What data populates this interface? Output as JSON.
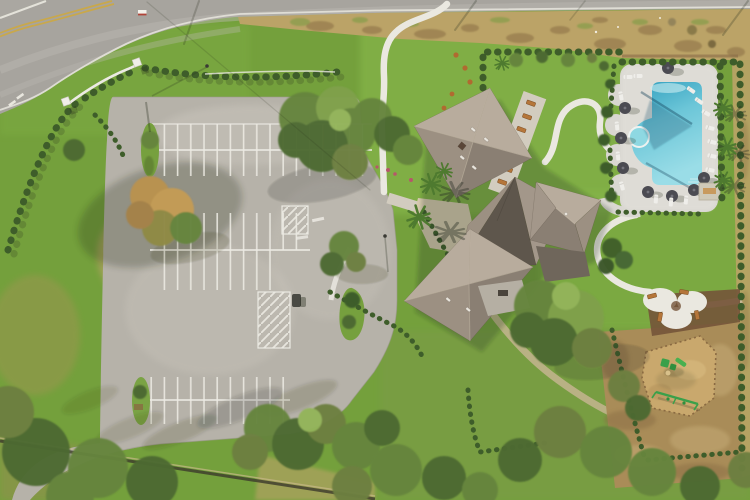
{
  "scene": {
    "type": "aerial-drone-photograph",
    "alt": "Aerial top-down drone view of a community clubhouse amenity center with a large empty parking lot, hip-roofed clubhouse, free-form swimming pool with white paver deck, playground with mulch, curving white sidewalks, hedges, palms and oak trees beside a curving two-lane road",
    "time_of_day": "daytime"
  },
  "road": {
    "lanes": 2,
    "center_line": "double-yellow",
    "edge_line": "white",
    "shape": "runs along top edge, curving down to exit left edge",
    "shoulder": "dry tan grass strip with dirt patches"
  },
  "parking_lot": {
    "surface": "light gray asphalt",
    "stall_rows": 3,
    "stall_line_color": "white",
    "handicap_hatch_zones": 2,
    "landscape_islands": 2,
    "vehicles": 1,
    "state": "empty"
  },
  "clubhouse": {
    "roof_style": "multiple hip roofs meeting in a star",
    "roof_color": "taupe-gray shingle",
    "wings": 4,
    "patio_benches": 7,
    "roof_vents": 6
  },
  "pool_area": {
    "water_color": "turquoise",
    "deck": "white pavers",
    "shape": "rectangle with scalloped west lobes and round spa",
    "loungers": 16,
    "umbrellas": 8,
    "hedge_border": true,
    "palms_east": 3
  },
  "playground": {
    "surface": "tan engineered mulch",
    "equipment": [
      "play-structure",
      "slide",
      "swing-set"
    ],
    "pad": "white concrete with 4 benches",
    "surrounding": "bare dirt field with hedge rows"
  },
  "landscape": {
    "entrance_monument": "white curved wall with two square posts",
    "hedge_style": "rows of round boxwood shrubs",
    "palms_total": 7,
    "autumn_tree": 1,
    "oak_clusters": 6,
    "perimeter_fence_bottom": true
  },
  "palette": {
    "grass_base": "#74a03c",
    "grass_bright": "#8abb4e",
    "grass_verge": "#7dab43",
    "grass_olive": "#7d9a4b",
    "dry_grass": "#bba367",
    "dirt": "#a98c58",
    "dirt_dark": "#8a6e45",
    "mulch": "#c9a86d",
    "mulch_dark": "#74543a",
    "road": "#a7a49e",
    "road_light": "#bcb9b2",
    "curb_white": "#e4e2da",
    "line_yellow": "#c9a84b",
    "lot": "#b6b2a9",
    "lot_light": "#c9c5bc",
    "stripe_white": "#eceae3",
    "concrete": "#d2ccbf",
    "apron": "#d6c9ae",
    "path_white": "#eae8e0",
    "roof_base": "#a3978a",
    "roof_light": "#b8ac9d",
    "roof_mid": "#9c9082",
    "roof_dark": "#8a7f73",
    "roof_darkest": "#5e564c",
    "ridge": "#c8bcab",
    "deck_gray": "#b5afa3",
    "pool_deck": "#d9d7d1",
    "water_deep": "#2f9dbd",
    "water_mid": "#6cc6d8",
    "water_light": "#9adde7",
    "spa": "#8ed8e2",
    "umbrella": "#4b4b52",
    "chair": "#efeeea",
    "bench": "#b5763a",
    "hedge": "#3e5d2a",
    "canopy_dark": "#4e6a33",
    "canopy_mid": "#66853e",
    "canopy_light": "#7fa04b",
    "canopy_olive": "#6d7f41",
    "canopy_hi": "#93b45a",
    "autumn1": "#b9924f",
    "autumn2": "#c49b55",
    "palm": "#4e7a2f",
    "play_green": "#3aa04a",
    "post_white": "#f0eee8",
    "sign_red": "#b04438",
    "flower": "#b5586a",
    "shadow": "rgba(38,45,28,0.45)"
  }
}
